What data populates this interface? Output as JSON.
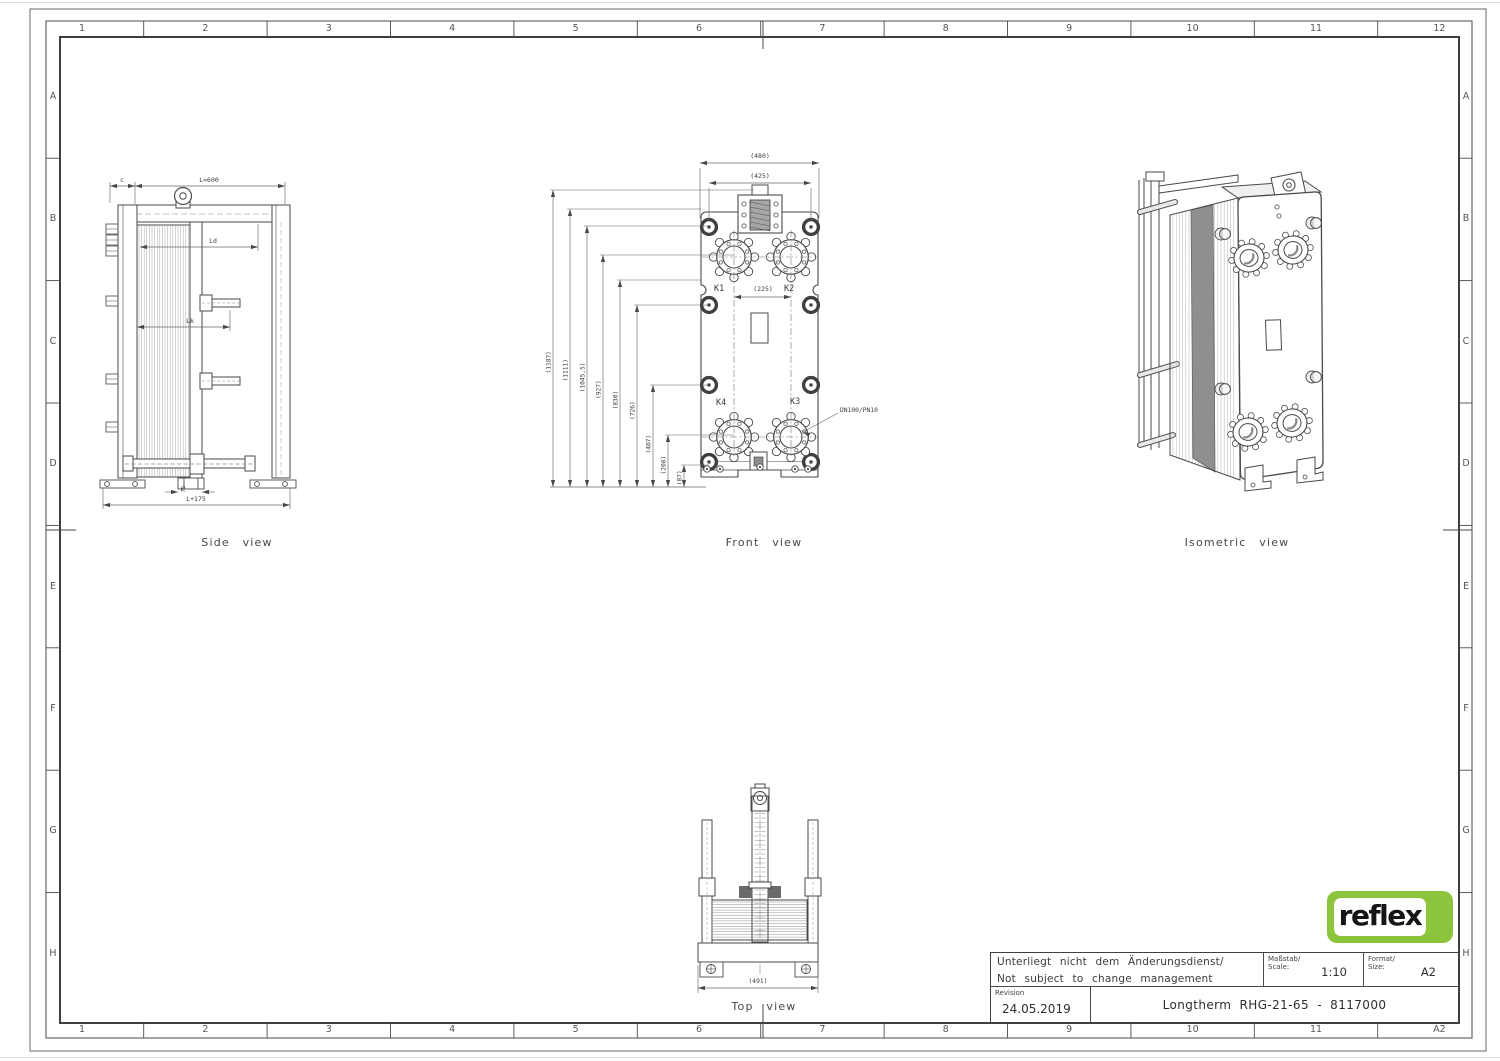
{
  "frame": {
    "columns": [
      "1",
      "2",
      "3",
      "4",
      "5",
      "6",
      "7",
      "8",
      "9",
      "10",
      "11",
      "12"
    ],
    "rows": [
      "A",
      "B",
      "C",
      "D",
      "E",
      "F",
      "G",
      "H"
    ],
    "corner_label": "A2"
  },
  "captions": {
    "side": "Side view",
    "front": "Front view",
    "iso": "Isometric view",
    "top": "Top view"
  },
  "side_view": {
    "dim_c": "c",
    "dim_length": "L=600",
    "dim_ld": "Ld",
    "dim_lk": "Lk",
    "dim_foot": "75",
    "dim_overall": "L+175"
  },
  "front_view": {
    "dim_width_outer": "(480)",
    "dim_width_inner": "(425)",
    "dim_port_spacing": "(225)",
    "left_dims": [
      "(1187)",
      "(1111)",
      "(1045,5)",
      "(927)",
      "(830)",
      "(726)",
      "(407)",
      "(208)",
      "(87)"
    ],
    "k1": "K1",
    "k2": "K2",
    "k3": "K3",
    "k4": "K4",
    "connection_label": "DN100/PN10"
  },
  "top_view": {
    "dim_width": "(491)"
  },
  "title_block": {
    "note_line1": "Unterliegt nicht dem Änderungsdienst/",
    "note_line2": "Not subject to change management",
    "scale_label_de": "Maßstab/",
    "scale_label_en": "Scale:",
    "scale_value": "1:10",
    "format_label_de": "Format/",
    "format_label_en": "Size:",
    "format_value": "A2",
    "revision_label": "Revision",
    "revision_date": "24.05.2019",
    "drawing_title": "Longtherm RHG-21-65 - 8117000"
  },
  "logo": {
    "text": "reflex",
    "color": "#8cc43c"
  }
}
